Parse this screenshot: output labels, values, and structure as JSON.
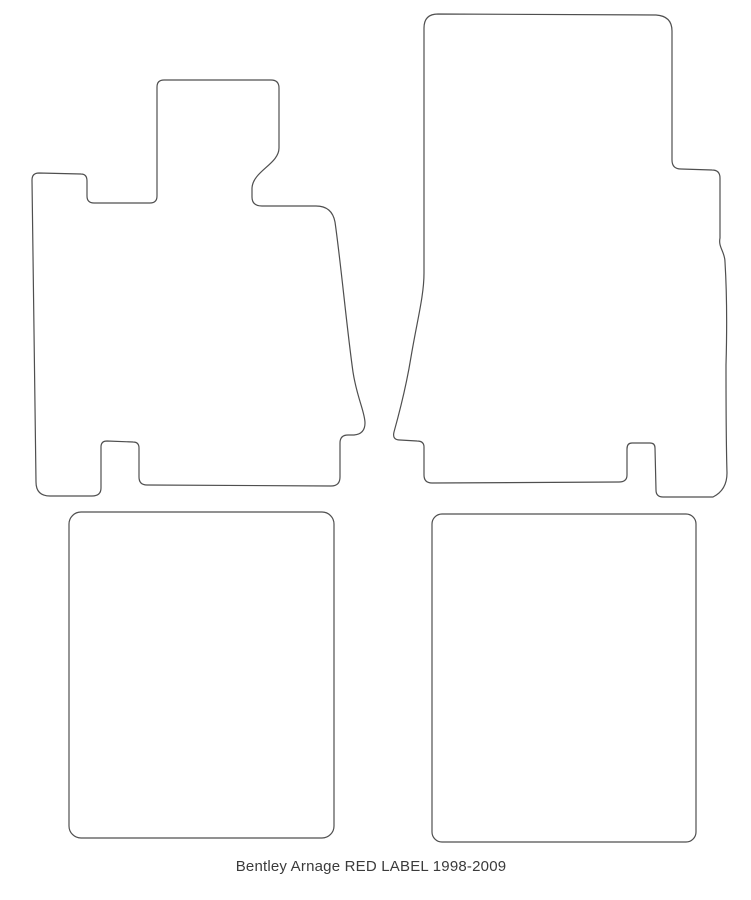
{
  "style": {
    "background": "#ffffff",
    "outline_color": "#4f4f4f",
    "caption_color": "#3b3b3b"
  },
  "caption": {
    "text": "Bentley Arnage RED LABEL 1998-2009"
  },
  "mats": [
    {
      "name": "front-left-mat"
    },
    {
      "name": "front-right-mat"
    },
    {
      "name": "rear-left-mat"
    },
    {
      "name": "rear-right-mat"
    }
  ]
}
